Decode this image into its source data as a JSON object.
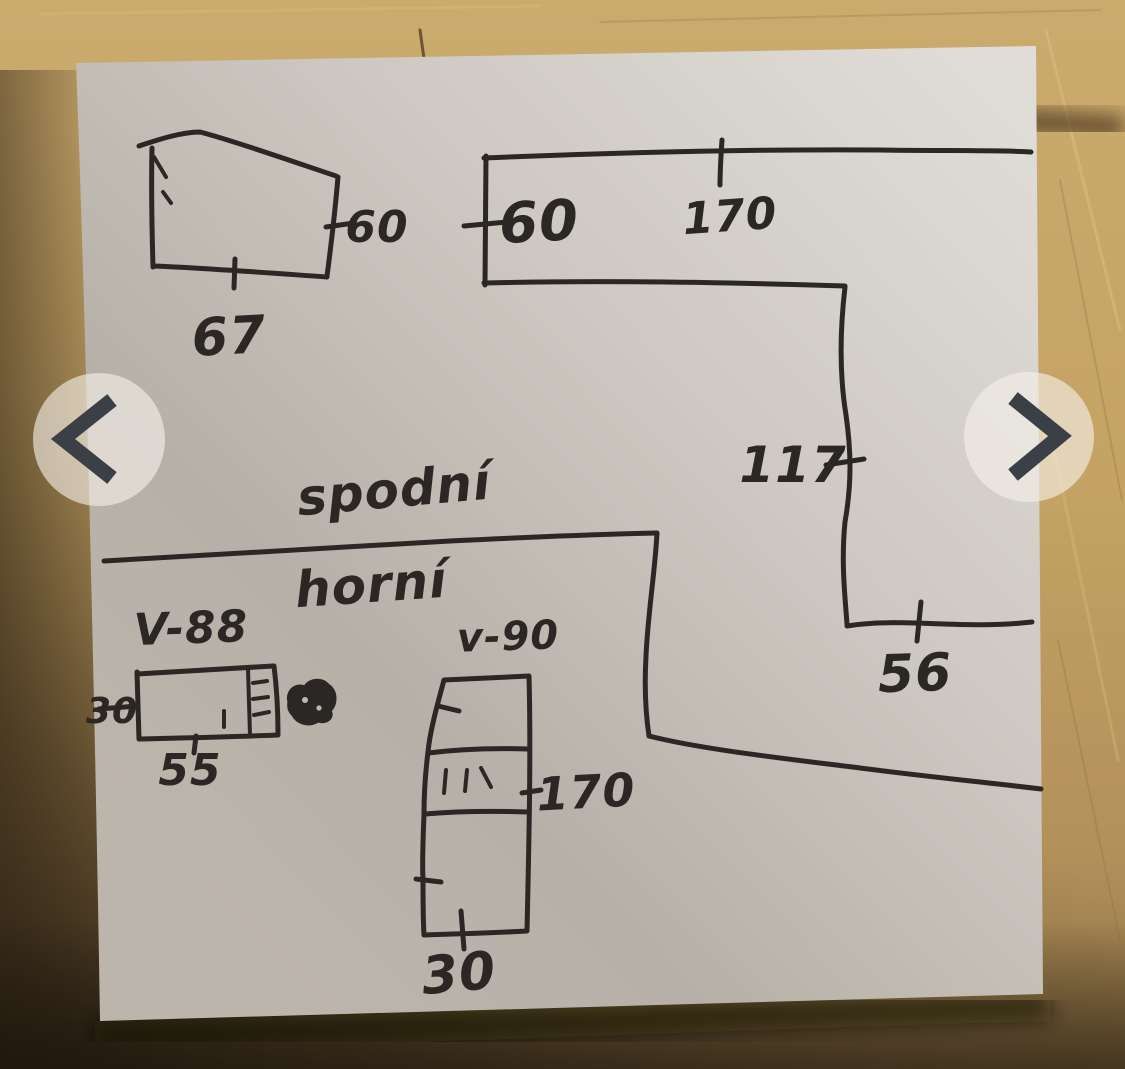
{
  "carousel": {
    "prev_icon": "chevron-left",
    "next_icon": "chevron-right"
  },
  "sketch": {
    "section_labels": {
      "bottom_row": "spodní",
      "top_row": "horní"
    },
    "unit_labels": {
      "v88": "V-88",
      "v90": "v-90"
    },
    "dimensions": {
      "small_shape_height": "60",
      "small_shape_width": "67",
      "top_band_height": "60",
      "top_band_length": "170",
      "right_drop_height": "117",
      "right_drop_width": "56",
      "v88_depth": "30",
      "v88_width": "55",
      "v90_height": "170",
      "v90_width": "30"
    }
  },
  "colors": {
    "ink": "#2b2724",
    "paper": "#c9c4bd",
    "wood": "#c4a167",
    "arrow_glyph": "#3a4046",
    "arrow_circle": "rgba(246,241,234,0.62)"
  }
}
